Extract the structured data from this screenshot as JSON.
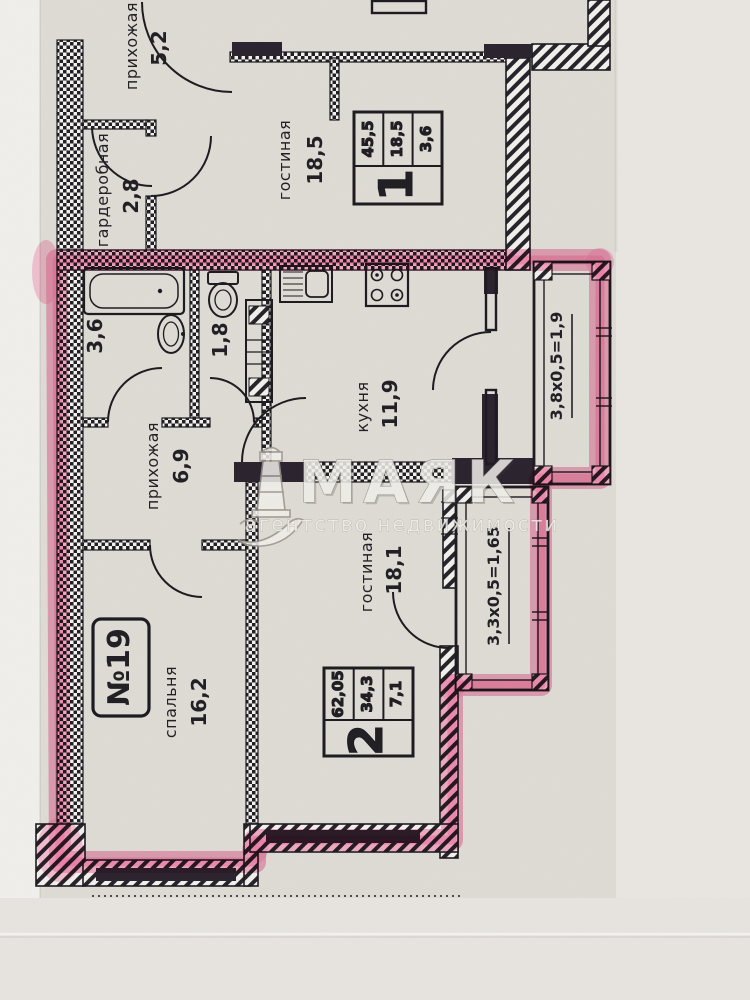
{
  "plan": {
    "unit_top": {
      "hallway_name": "прихожая",
      "hallway_area": "5,2",
      "wardrobe_name": "гардеробная",
      "wardrobe_area": "2,8",
      "living_name": "гостиная",
      "living_area": "18,5",
      "stamp_rooms": "1",
      "stamp_total": "45,5",
      "stamp_living": "18,5",
      "stamp_kitchen": "3,6"
    },
    "unit_19": {
      "number": "№19",
      "bathroom_area": "3,6",
      "wc_area": "1,8",
      "kitchen_name": "кухня",
      "kitchen_area": "11,9",
      "hallway_name": "прихожая",
      "hallway_area": "6,9",
      "living_name": "гостиная",
      "living_area": "18,1",
      "bedroom_name": "спальня",
      "bedroom_area": "16,2",
      "balcony_kitchen_dims": "3,8х0,5=1,9",
      "balcony_living_dims": "3,3х0,5=1,65",
      "stamp_rooms": "2",
      "stamp_total": "62,05",
      "stamp_living": "34,3",
      "stamp_kitchen": "7,1"
    }
  },
  "watermark": {
    "brand": "МАЯК",
    "tagline": "агентство недвижимости"
  },
  "colors": {
    "highlight": "#f4679d",
    "paper": "#e0ddd7",
    "ink": "#1d1b20"
  }
}
